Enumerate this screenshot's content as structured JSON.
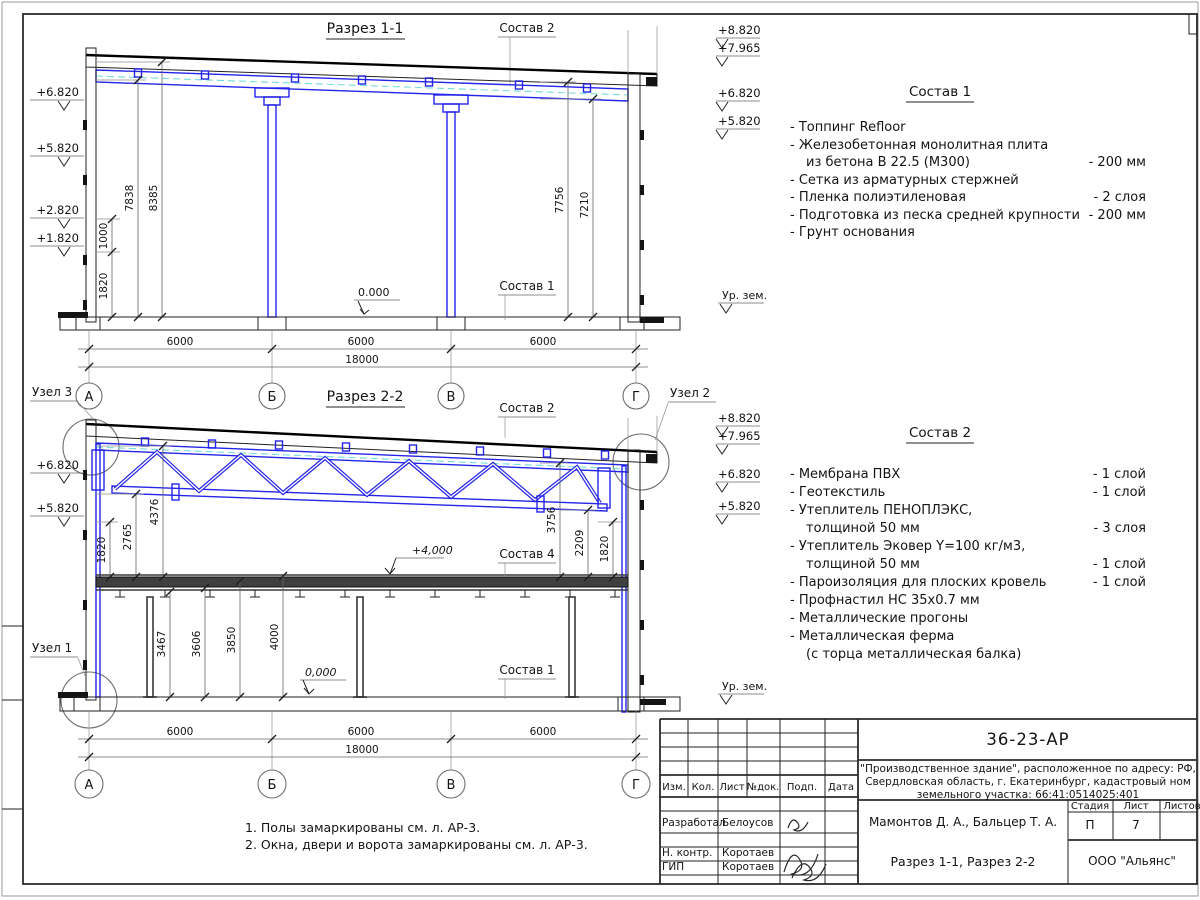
{
  "section1": {
    "title": "Разрез 1-1",
    "sostav2_label": "Состав 2",
    "sostav1_label": "Состав 1",
    "elev_left": [
      "+6.820",
      "+5.820",
      "+2.820",
      "+1.820"
    ],
    "elev_right": [
      "+8.820",
      "+7.965",
      "+6.820",
      "+5.820"
    ],
    "ground_label": "Ур. зем.",
    "zero_mark": "0.000",
    "dim_7838": "7838",
    "dim_8385": "8385",
    "dim_1000": "1000",
    "dim_1820": "1820",
    "dim_7756": "7756",
    "dim_7210": "7210",
    "dims_bottom": [
      "6000",
      "6000",
      "6000"
    ],
    "dim_total": "18000",
    "axes": [
      "А",
      "Б",
      "В",
      "Г"
    ]
  },
  "section2": {
    "title": "Разрез 2-2",
    "uzel1_label": "Узел 1",
    "uzel2_label": "Узел 2",
    "uzel3_label": "Узел 3",
    "sostav2_label": "Состав 2",
    "sostav4_label": "Состав 4",
    "sostav1_label": "Состав 1",
    "elev_left": [
      "+6.820",
      "+5.820"
    ],
    "elev_right": [
      "+8.820",
      "+7.965",
      "+6.820",
      "+5.820"
    ],
    "ground_label": "Ур. зем.",
    "zero_mark": "0,000",
    "plus4_mark": "+4,000",
    "dims_left": [
      "1820",
      "2765",
      "4376"
    ],
    "dims_below": [
      "3467",
      "3606",
      "3850",
      "4000"
    ],
    "dims_right": [
      "3756",
      "2209",
      "1820"
    ],
    "dims_bottom": [
      "6000",
      "6000",
      "6000"
    ],
    "dim_total": "18000",
    "axes": [
      "А",
      "Б",
      "В",
      "Г"
    ]
  },
  "sostav1": {
    "title": "Состав 1",
    "rows": [
      {
        "text": "- Топпинг Refloor",
        "value": ""
      },
      {
        "text": "- Железобетонная  монолитная плита",
        "value": ""
      },
      {
        "text": "из бетона В 22.5 (М300)",
        "value": "- 200 мм"
      },
      {
        "text": "- Сетка из арматурных стержней",
        "value": ""
      },
      {
        "text": "- Пленка полиэтиленовая",
        "value": "- 2 слоя"
      },
      {
        "text": "- Подготовка из песка средней крупности",
        "value": "- 200 мм"
      },
      {
        "text": "- Грунт основания",
        "value": ""
      }
    ]
  },
  "sostav2": {
    "title": "Состав 2",
    "rows": [
      {
        "text": "- Мембрана ПВХ",
        "value": "- 1 слой"
      },
      {
        "text": "- Геотекстиль",
        "value": "- 1 слой"
      },
      {
        "text": "- Утеплитель ПЕНОПЛЭКС,",
        "value": ""
      },
      {
        "text": "толщиной 50 мм",
        "value": "- 3 слоя"
      },
      {
        "text": "- Утеплитель Эковер Y=100 кг/м3,",
        "value": ""
      },
      {
        "text": "толщиной 50 мм",
        "value": "- 1 слой"
      },
      {
        "text": "- Пароизоляция для плоских кровель",
        "value": "- 1 слой"
      },
      {
        "text": "- Профнастил НС 35х0.7 мм",
        "value": ""
      },
      {
        "text": "- Металлические прогоны",
        "value": ""
      },
      {
        "text": "- Металлическая ферма",
        "value": ""
      },
      {
        "text": "(с торца металлическая балка)",
        "value": ""
      }
    ]
  },
  "notes": [
    "1. Полы замаркированы см. л. АР-3.",
    "2. Окна, двери и ворота замаркированы см. л. АР-3."
  ],
  "titleblock": {
    "doc_number": "36-23-АР",
    "project_line1": "\"Производственное здание\", расположенное по адресу: РФ,",
    "project_line2": "Свердловская область, г. Екатеринбург, кадастровый ном",
    "project_line3": "земельного участка: 66:41:0514025:401",
    "col_izm": "Изм.",
    "col_kol": "Кол.",
    "col_list": "Лист",
    "col_ndok": "№док.",
    "col_podp": "Подп.",
    "col_data": "Дата",
    "row1_role": "Разработал",
    "row1_name": "Белоусов",
    "row2_role": "Н. контр.",
    "row2_name": "Коротаев",
    "row3_role": "ГИП",
    "row3_name": "Коротаев",
    "authors": "Мамонтов Д. А., Бальцер Т. А.",
    "stage_label": "Стадия",
    "sheet_label": "Лист",
    "sheets_label": "Листов",
    "stage": "П",
    "sheet_num": "7",
    "drawing_title": "Разрез 1-1, Разрез 2-2",
    "company": "ООО \"Альянс\""
  }
}
